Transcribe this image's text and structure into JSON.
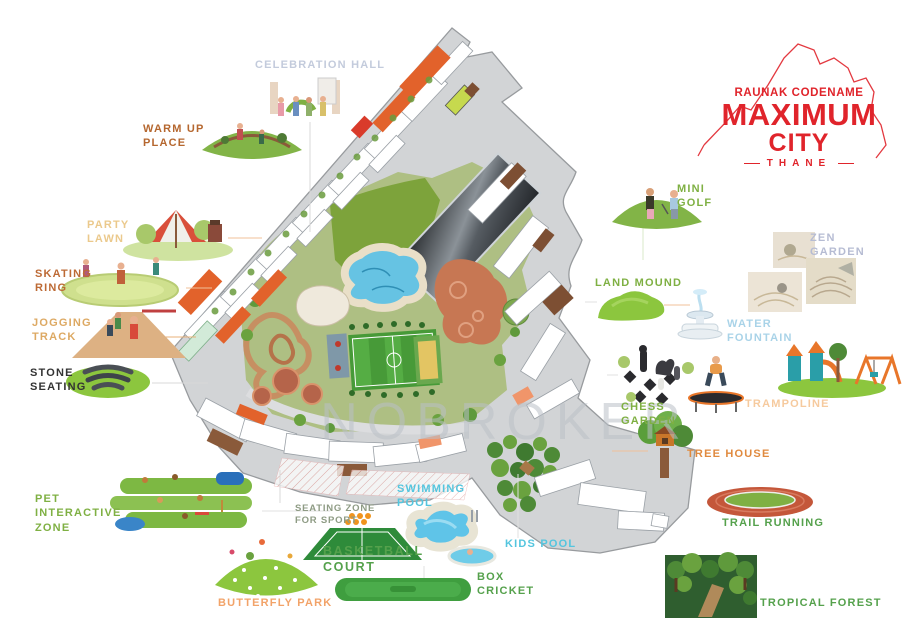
{
  "title": "Raunak Codename Maximum City Thane - Master Layout Plan",
  "logo": {
    "line1": "RAUNAK CODENAME",
    "line2": "MAXIMUM",
    "line3": "CITY",
    "line4": "THANE",
    "color": "#E0242B"
  },
  "watermark": {
    "text": "NOBROKER",
    "color": "rgba(186,192,199,0.55)"
  },
  "labels": {
    "celebration_hall": {
      "text": "CELEBRATION HALL",
      "color": "#C3CBDC"
    },
    "warm_up_place": {
      "text": "WARM UP\nPLACE",
      "color": "#B5672F"
    },
    "party_lawn": {
      "text": "PARTY\nLAWN",
      "color": "#EBC98C"
    },
    "skating_ring": {
      "text": "SKATING\nRING",
      "color": "#BD6A35"
    },
    "jogging_track": {
      "text": "JOGGING\nTRACK",
      "color": "#DDA963"
    },
    "stone_seating": {
      "text": "STONE\nSEATING",
      "color": "#333333"
    },
    "pet_interactive_zone": {
      "text": "PET\nINTERACTIVE\nZONE",
      "color": "#7FB043"
    },
    "seating_zone_for_sport": {
      "text": "SEATING ZONE\nFOR SPORT",
      "color": "#8E9B84"
    },
    "basketball_court": {
      "text": "BASKETBALL\nCOURT",
      "color": "#55A14C"
    },
    "butterfly_park": {
      "text": "BUTTERFLY PARK",
      "color": "#F2A369"
    },
    "swimming_pool": {
      "text": "SWIMMING\nPOOL",
      "color": "#54C5DE"
    },
    "kids_pool": {
      "text": "KIDS POOL",
      "color": "#54C5DE"
    },
    "box_cricket": {
      "text": "BOX\nCRICKET",
      "color": "#55A14C"
    },
    "tropical_forest": {
      "text": "TROPICAL FOREST",
      "color": "#55A14C"
    },
    "trail_running": {
      "text": "TRAIL RUNNING",
      "color": "#55A14C"
    },
    "tree_house": {
      "text": "TREE HOUSE",
      "color": "#E08A3F"
    },
    "trampoline": {
      "text": "TRAMPOLINE",
      "color": "#F6CA9E"
    },
    "chess_garden": {
      "text": "CHESS\nGARDEN",
      "color": "#7FB043"
    },
    "water_fountain": {
      "text": "WATER\nFOUNTAIN",
      "color": "#A9D3E8"
    },
    "zen_garden": {
      "text": "ZEN\nGARDEN",
      "color": "#B6BCD3"
    },
    "land_mound": {
      "text": "LAND MOUND",
      "color": "#7FB043"
    },
    "mini_golf": {
      "text": "MINI\nGOLF",
      "color": "#7FB043"
    }
  }
}
